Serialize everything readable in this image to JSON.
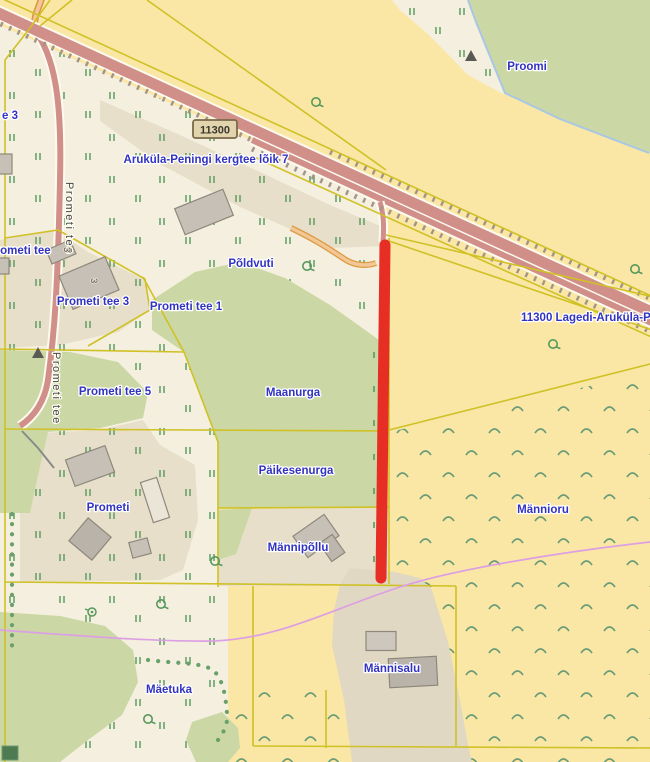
{
  "map": {
    "badge_ref": "11300",
    "street_names": {
      "prometi_tee_vertical_upper": "Prometi tee",
      "prometi_tee_vertical_lower": "Prometi tee",
      "prometi_tee_clipped": "Prometi tee",
      "kergtee_route": "Aruküla-Peningi kergtee lõik 7",
      "highway_name": "11300 Lagedi-Aruküla-Pen"
    },
    "place_names": {
      "e3_partial": "e 3",
      "prometi_tee_1": "Prometi tee 1",
      "prometi_tee_3": "Prometi tee 3",
      "prometi_tee_5": "Prometi tee 5",
      "poldvuti": "Põldvuti",
      "proomi": "Proomi",
      "maanurga": "Maanurga",
      "paikesenurga": "Päikesenurga",
      "prometi": "Prometi",
      "mannipollu": "Männipõllu",
      "mannioru": "Männioru",
      "maetuka": "Mäetuka",
      "mannisalu": "Männisalu"
    },
    "building_numbers": {
      "prometi_tee_3_small": "3",
      "prometi_tee_3_main": "3"
    },
    "symbols": {
      "tree": "deciduous-tree-symbol",
      "well": "well-symbol",
      "triangle": "landmark-triangle-symbol",
      "grassland_marks": "grass-tuft-marks",
      "scrub_marks": "scrub-caret-marks"
    },
    "colors": {
      "background": "#fae7a5",
      "parcel_cream": "#f4efdf",
      "farmyard_tan": "#e7dfc9",
      "forest_green": "#cbd8a5",
      "road_fill": "#d18f89",
      "minor_road_fill": "#f2c795",
      "parcel_boundary_yellow": "#cfc126",
      "route_highlight_red": "#e62e24",
      "overhead_line_purple": "#dc9fe3",
      "forest_edge_blue": "#a9c7e3",
      "label_blue": "#3233c1",
      "street_label_gray": "#45443e",
      "vegetation_green": "#5f9e63"
    }
  }
}
